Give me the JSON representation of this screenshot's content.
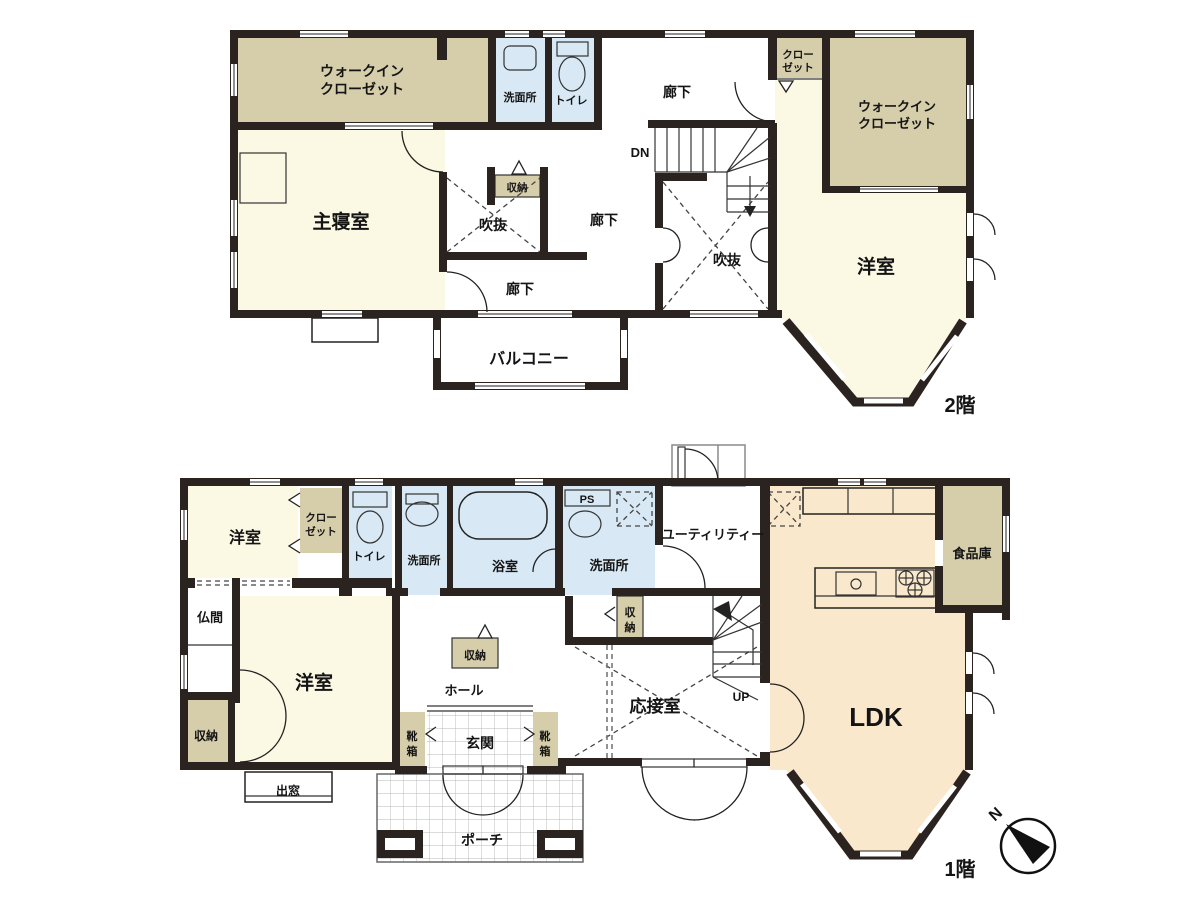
{
  "floor2": {
    "floor_label": "2階",
    "wic_left_l1": "ウォークイン",
    "wic_left_l2": "クローゼット",
    "washroom": "洗面所",
    "toilet": "トイレ",
    "corridor_top": "廊下",
    "corridor_mid": "廊下",
    "corridor_lower": "廊下",
    "closet_l1": "クロー",
    "closet_l2": "ゼット",
    "wic_right_l1": "ウォークイン",
    "wic_right_l2": "クローゼット",
    "master_bedroom": "主寝室",
    "storage": "収納",
    "void_left": "吹抜",
    "void_right": "吹抜",
    "dn": "DN",
    "western_room": "洋室",
    "balcony": "バルコニー"
  },
  "floor1": {
    "floor_label": "1階",
    "western_room_small": "洋室",
    "closet_l1": "クロー",
    "closet_l2": "ゼット",
    "toilet": "トイレ",
    "washroom_left": "洗面所",
    "bathroom": "浴室",
    "ps": "PS",
    "washroom_right": "洗面所",
    "utility": "ユーティリティー",
    "storage_mid": [
      "収",
      "納"
    ],
    "butsuma": "仏間",
    "western_room_large": "洋室",
    "storage_hall": "収納",
    "hall": "ホール",
    "storage_left": "収納",
    "bay_window": "出窓",
    "shoe_box": [
      "靴",
      "箱"
    ],
    "entrance": "玄関",
    "porch": "ポーチ",
    "reception": "応接室",
    "up": "UP",
    "ldk": "LDK",
    "pantry": "食品庫"
  },
  "compass": {
    "north": "N"
  },
  "colors": {
    "wall": "#2b2320",
    "room_cream": "#fbf8e4",
    "room_tan": "#d6cdaa",
    "room_blue": "#d8e9f5",
    "room_peach": "#fae8cd"
  }
}
